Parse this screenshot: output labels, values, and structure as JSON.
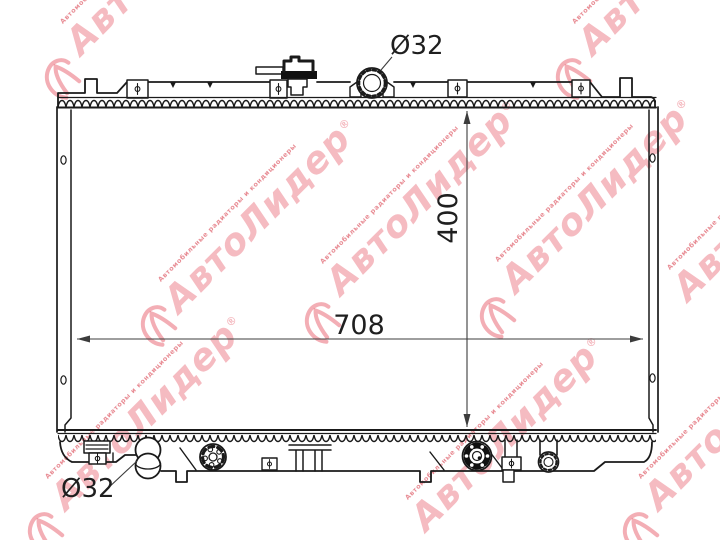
{
  "drawing": {
    "dimensions": {
      "core_width": "708",
      "core_height": "400",
      "inlet_diameter": "Ø32",
      "outlet_diameter": "Ø32"
    },
    "line_color": "#1a1a1a",
    "dim_color": "#3c3c3c"
  },
  "watermark": {
    "brand": "АвтоЛидер",
    "reg": "®",
    "slogan": "Автомобильные радиаторы и кондиционеры",
    "big_color": "rgba(231,85,100,0.40)",
    "small_color": "rgba(214,45,60,0.55)",
    "logo_color": "rgba(228,75,90,0.45)"
  }
}
